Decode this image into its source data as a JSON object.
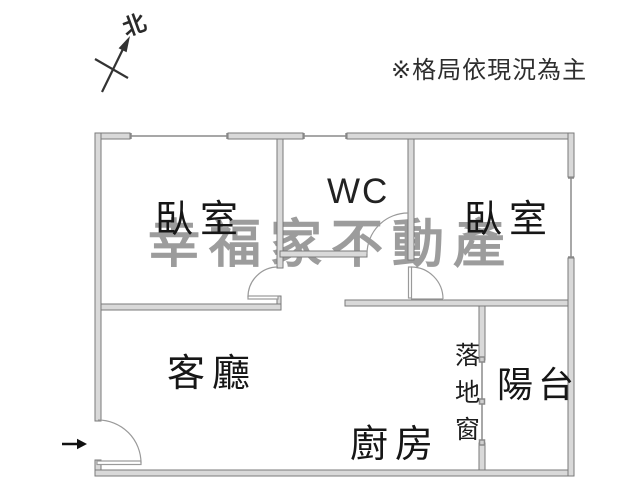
{
  "plan": {
    "disclaimer": "※格局依現況為主",
    "watermark": "幸福家不動產",
    "north_label": "北",
    "rooms": {
      "bedroom_left": "臥室",
      "wc": "WC",
      "bedroom_right": "臥室",
      "living_room": "客廳",
      "kitchen": "廚房",
      "balcony": "陽台",
      "floor_window": "落地窗"
    },
    "colors": {
      "wall_fill": "#d9d9d9",
      "wall_stroke": "#7a7a7a",
      "window_line": "#8a8a8a",
      "door_line": "#9a9a9a",
      "text": "#161616",
      "watermark": "#9c9c9c"
    }
  }
}
